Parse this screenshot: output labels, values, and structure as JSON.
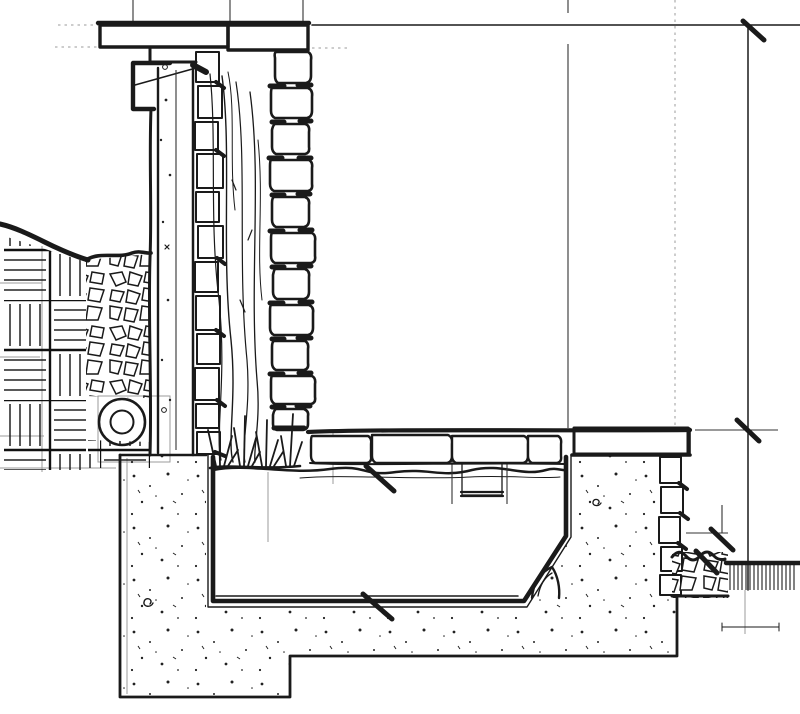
{
  "drawing": {
    "type": "architectural-section-sketch",
    "title": "Hand-drawn ink section detail: stone-faced garden wall with capped coping and drip channel, water spout cascading down the wall face past planting into a sunken basin with skimmer box, on a stepped concrete footing, with soil, gravel drainage bed, perforated drain pipe, and upper and lower grade levels at right",
    "medium": "black ink on white paper",
    "text_labels": []
  },
  "colors": {
    "paper": "#ffffff",
    "ink": "#1a1a1a",
    "guide": "#9b9b9b"
  },
  "components": [
    {
      "id": "wall-cap-coping",
      "label": "hatched cap / coping stone at top of wall"
    },
    {
      "id": "drip-channel-bracket",
      "label": "metal drip channel bracket under cap"
    },
    {
      "id": "water-spout",
      "label": "spout feeding the cascade"
    },
    {
      "id": "stone-facing-bricks",
      "label": "stacked facing stones (elevation) on far wall face"
    },
    {
      "id": "mortar-core-blocks",
      "label": "hatched mortar/rubble core in section"
    },
    {
      "id": "concrete-stem",
      "label": "speckled concrete stem of wall"
    },
    {
      "id": "water-cascade",
      "label": "wavy water flow lines down wall face"
    },
    {
      "id": "planting-tufts",
      "label": "grass / marginal planting at basin edge"
    },
    {
      "id": "soil-basket-weave",
      "label": "basket-weave soil hatch behind wall"
    },
    {
      "id": "drainage-gravel",
      "label": "rubble drainage bed against wall"
    },
    {
      "id": "drain-pipe",
      "label": "round drain pipe at wall base"
    },
    {
      "id": "ground-line",
      "label": "sloping ground line at left"
    },
    {
      "id": "water-line",
      "label": "wavy water level line in basin"
    },
    {
      "id": "skimmer-box",
      "label": "small box detail at water line"
    },
    {
      "id": "basin-liner",
      "label": "basin walls and sloped bottom"
    },
    {
      "id": "concrete-footing",
      "label": "stepped speckled concrete footing"
    },
    {
      "id": "right-coping-slab",
      "label": "hatched coping slab over right basin wall"
    },
    {
      "id": "upper-grade-line",
      "label": "upper grade / paving level at right"
    },
    {
      "id": "lower-grade-line",
      "label": "lower grade level with vertical hatch at far right"
    },
    {
      "id": "right-rubble-bed",
      "label": "rubble bed at lower grade"
    },
    {
      "id": "dimension-ticks",
      "label": "bold diagonal tick marks on reference lines"
    },
    {
      "id": "guide-lines",
      "label": "faint construction / projection guide lines"
    }
  ]
}
